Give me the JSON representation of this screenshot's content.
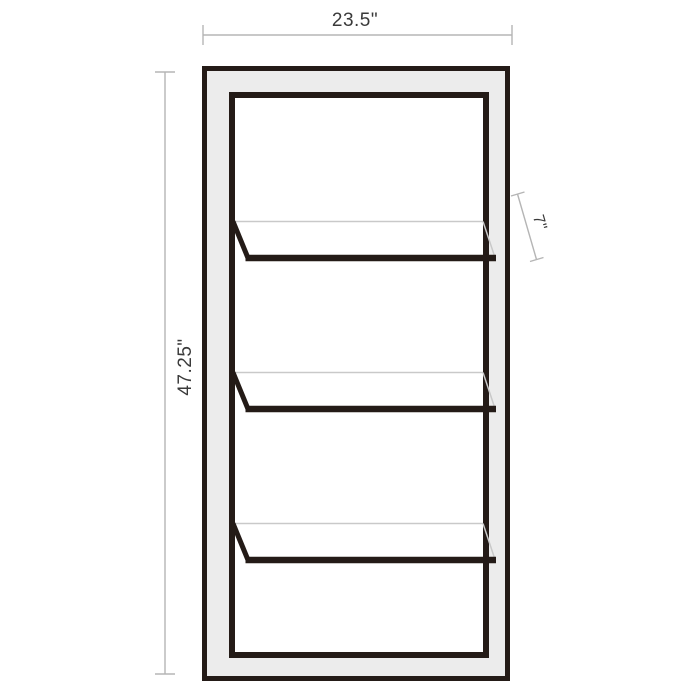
{
  "diagram": {
    "kind": "furniture-dimension-diagram",
    "shelf_count": 3,
    "dimensions": {
      "width": "23.5\"",
      "height": "47.25\"",
      "depth": "7\""
    },
    "colors": {
      "frame": "#241b17",
      "side_panel_fill": "#ececec",
      "interior_fill": "#ffffff",
      "shelf_hidden_edge": "#c9c9c9",
      "dimension_line": "#b5b5b5",
      "dimension_text": "#3a3a3a",
      "background": "#ffffff"
    }
  }
}
